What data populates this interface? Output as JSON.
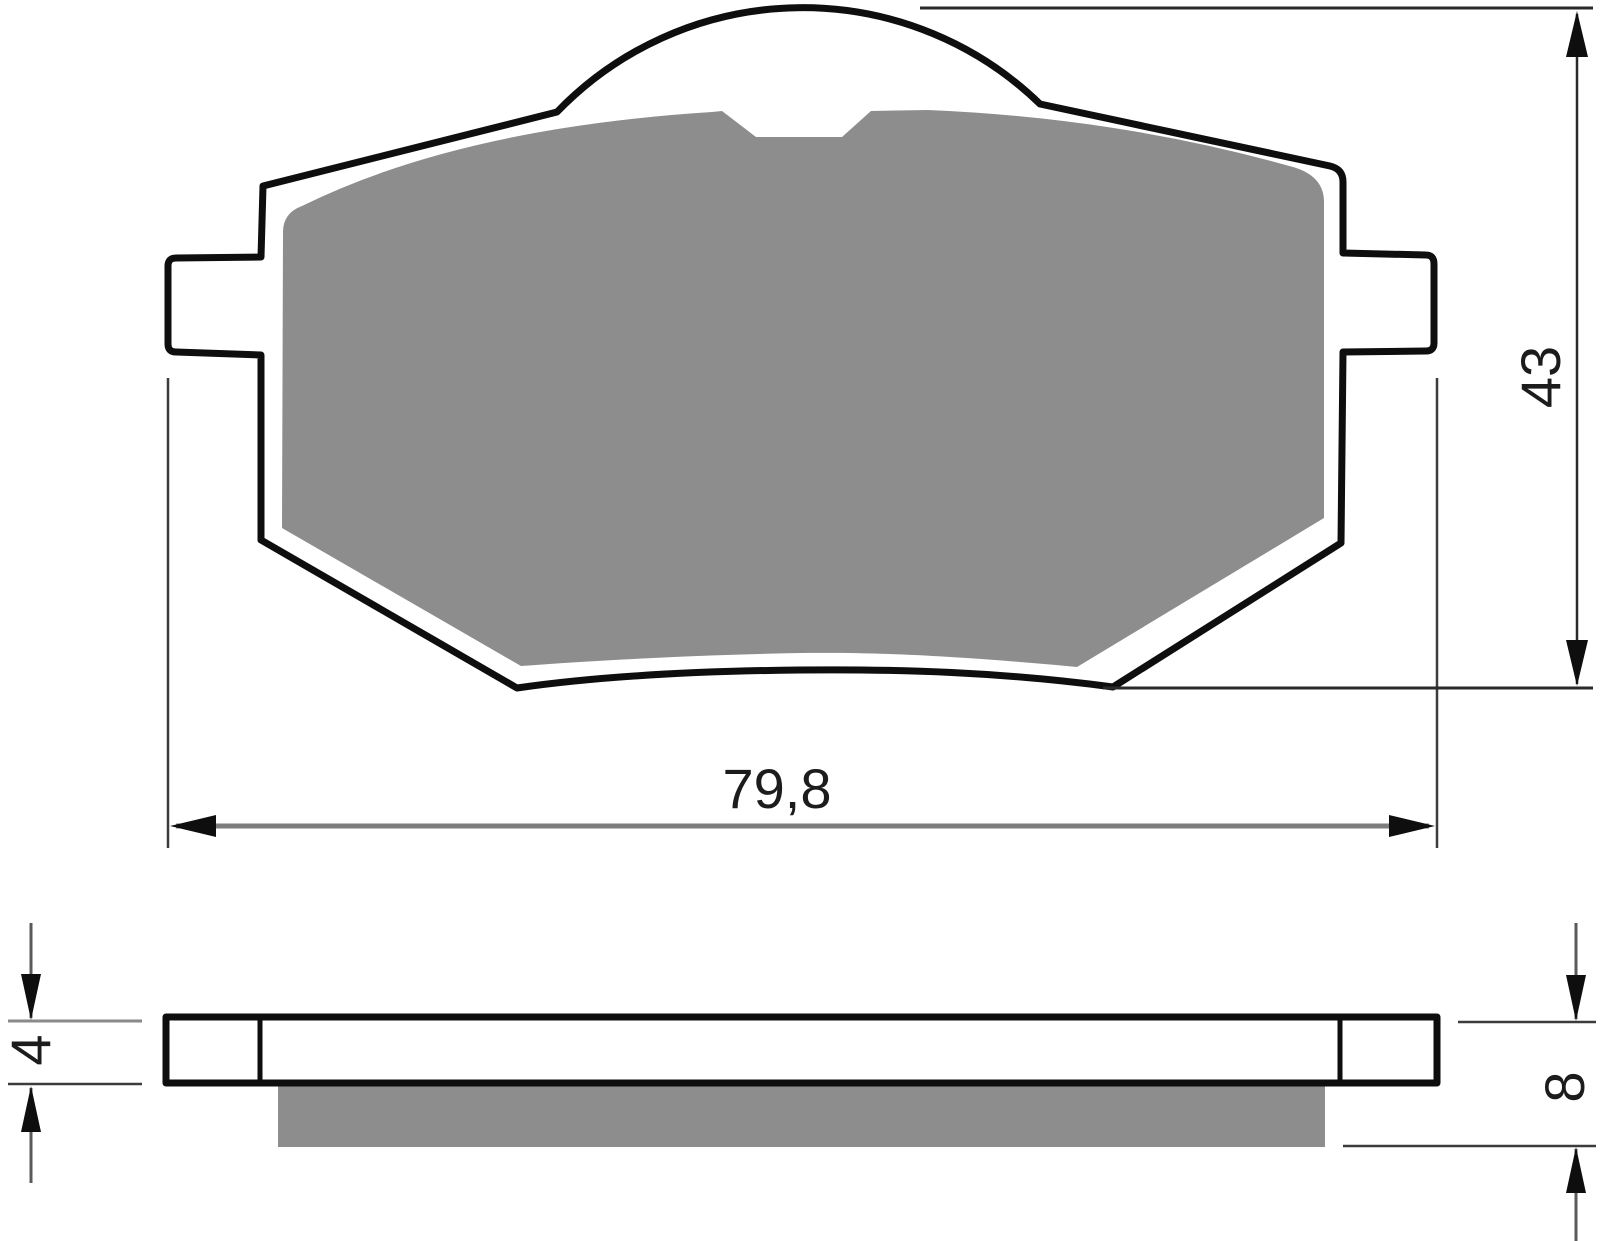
{
  "drawing": {
    "type": "brake-pad-technical-drawing",
    "dimensions": {
      "width": {
        "label": "79,8"
      },
      "height": {
        "label": "43"
      },
      "backing_thickness": {
        "label": "4"
      },
      "total_thickness": {
        "label": "8"
      }
    },
    "colors": {
      "friction_material": "#8d8d8d",
      "outline": "#0e0e0e",
      "plate_fill": "#ffffff",
      "dim_line_gray": "#7d7d7d",
      "dim_line_dark": "#2a2a2a",
      "ext_line": "#3c3c3c",
      "background": "#ffffff"
    }
  }
}
